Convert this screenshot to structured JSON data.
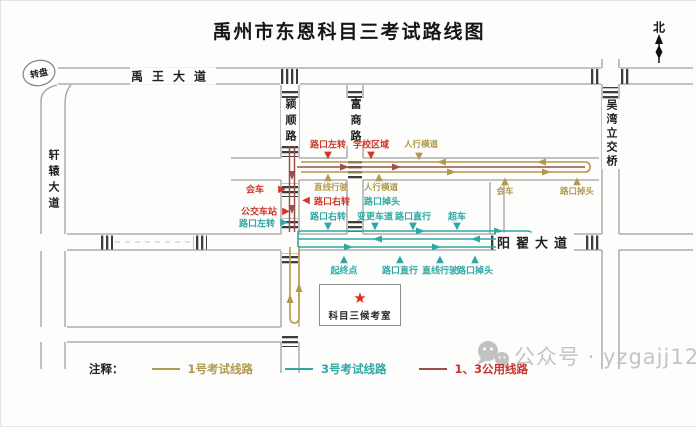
{
  "title": "禹州市东恩科目三考试路线图",
  "compass": {
    "north_label": "北"
  },
  "map": {
    "roundabout_label": "转盘",
    "roads": {
      "yuwang_avenue": "禹王大道",
      "xuanyuan_avenue": "轩辕大道",
      "yingshun_road": "颍顺路",
      "fushang_road": "富商路",
      "yangzhai_avenue": "阳翟大道",
      "wuwan_overpass": "吴湾立交桥"
    },
    "exam_room_label": "科目三候考室",
    "ann": {
      "red": {
        "turn_left": "路口左转",
        "school_zone": "学校区域",
        "meet_vehicle": "会车",
        "turn_right": "路口右转",
        "bus_stop": "公交车站"
      },
      "olive": {
        "crosswalk_top": "人行横道",
        "straight_drive": "直线行驶",
        "crosswalk_mid": "人行横道",
        "meet_vehicle": "会车",
        "u_turn": "路口掉头"
      },
      "teal": {
        "turn_left": "路口左转",
        "u_turn_mid": "路口掉头",
        "turn_right": "路口右转",
        "change_lane": "变更车道",
        "go_straight_top": "路口直行",
        "overtake": "超车",
        "start_end_point": "起终点",
        "go_straight_bottom": "路口直行",
        "straight_drive": "直线行驶",
        "u_turn_bottom": "路口掉头"
      }
    }
  },
  "legend": {
    "prefix": "注释：",
    "items": [
      {
        "label": "1号考试线路",
        "color": "#b09a4e"
      },
      {
        "label": "3号考试线路",
        "color": "#2fa8a4"
      },
      {
        "label": "1、3公用线路",
        "color": "#9c4f46"
      }
    ]
  },
  "watermark": {
    "icon": "wechat-icon",
    "text": "公众号 · yzgajj122"
  },
  "colors": {
    "route1_olive": "#b09a4e",
    "route3_teal": "#2fa8a4",
    "shared_red": "#9c4f46",
    "label_red": "#d0372a",
    "road_gray": "#a0a0a0",
    "crosswalk": "#3d3d3d",
    "star_red": "#e02b20",
    "watermark_gray": "#c4c4c4"
  }
}
